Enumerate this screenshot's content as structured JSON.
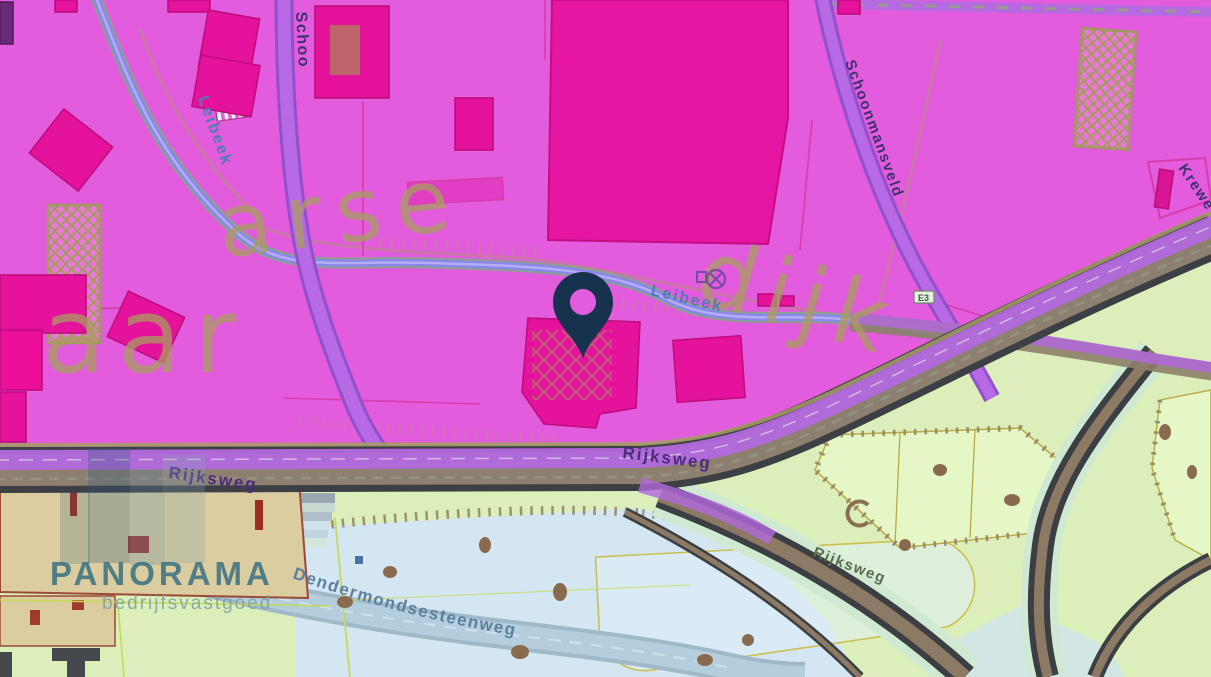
{
  "map": {
    "labels": {
      "leibeek_upper": "Leibeek",
      "leibeek_mid": "Leibeek",
      "schoo": "Schoo",
      "schoonmansveld": "Schoonmansveld",
      "krewe": "Krewe",
      "rijksweg_left": "Rijksweg",
      "rijksweg_mid": "Rijksweg",
      "rijksweg_se": "Rijksweg",
      "dendermondsesteenweg": "Dendermondsesteenweg",
      "badge_e3": "E3",
      "ghost_aar": "aar",
      "ghost_aarse": "arse",
      "ghost_dijk": "dijk"
    },
    "watermark": {
      "brand": "PANORAMA",
      "tagline": "bedrijfsvastgoed"
    },
    "marker": {
      "icon": "location-pin-icon",
      "color": "#16324e"
    },
    "colors": {
      "zone_magenta": "#e35cdd",
      "building_magenta": "#e5129c",
      "zone_green": "#dcefbb",
      "zone_blue": "#d4e6f1",
      "building_beige": "#dbcd9f",
      "road_purple": "#b76ae4",
      "road_dark": "#3c3f43",
      "road_brown": "#8e8070",
      "stream_blue": "#8b85ec",
      "ghost_text": "#a89e5e",
      "stream_label": "#4e7cb4",
      "street_label": "#4b2b7a",
      "watermark_teal": "#2f6b80"
    }
  }
}
